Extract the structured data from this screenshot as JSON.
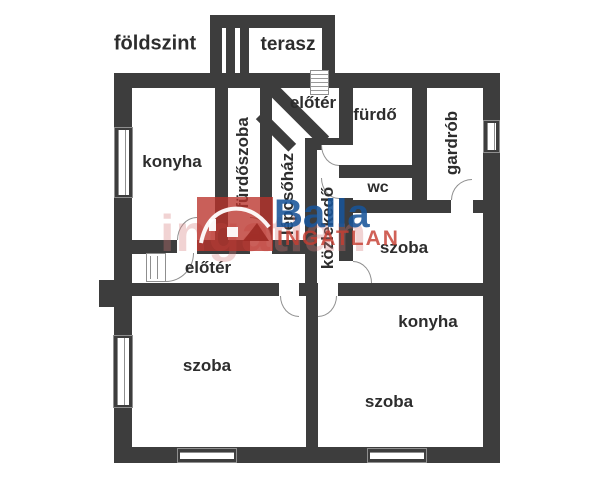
{
  "floor_label": "földszint",
  "rooms": {
    "terasz": "terasz",
    "eloter_top": "előtér",
    "konyha_top": "konyha",
    "furdoszoba": "fürdőszoba",
    "lepcsohaz": "lépcsőház",
    "kozlekedo": "közlekedő",
    "furdo": "fürdő",
    "gardrob": "gardrób",
    "wc": "wc",
    "szoba_middle": "szoba",
    "eloter_lower": "előtér",
    "szoba_bottom_left": "szoba",
    "konyha_bottom": "konyha",
    "szoba_bottom_right": "szoba"
  },
  "watermark": {
    "brand": "Balla",
    "subtitle": "INGATLAN",
    "script": "ingatlan"
  },
  "colors": {
    "wall": "#3d3d3d",
    "brand_blue": "#185499",
    "brand_red": "#ba322a"
  }
}
